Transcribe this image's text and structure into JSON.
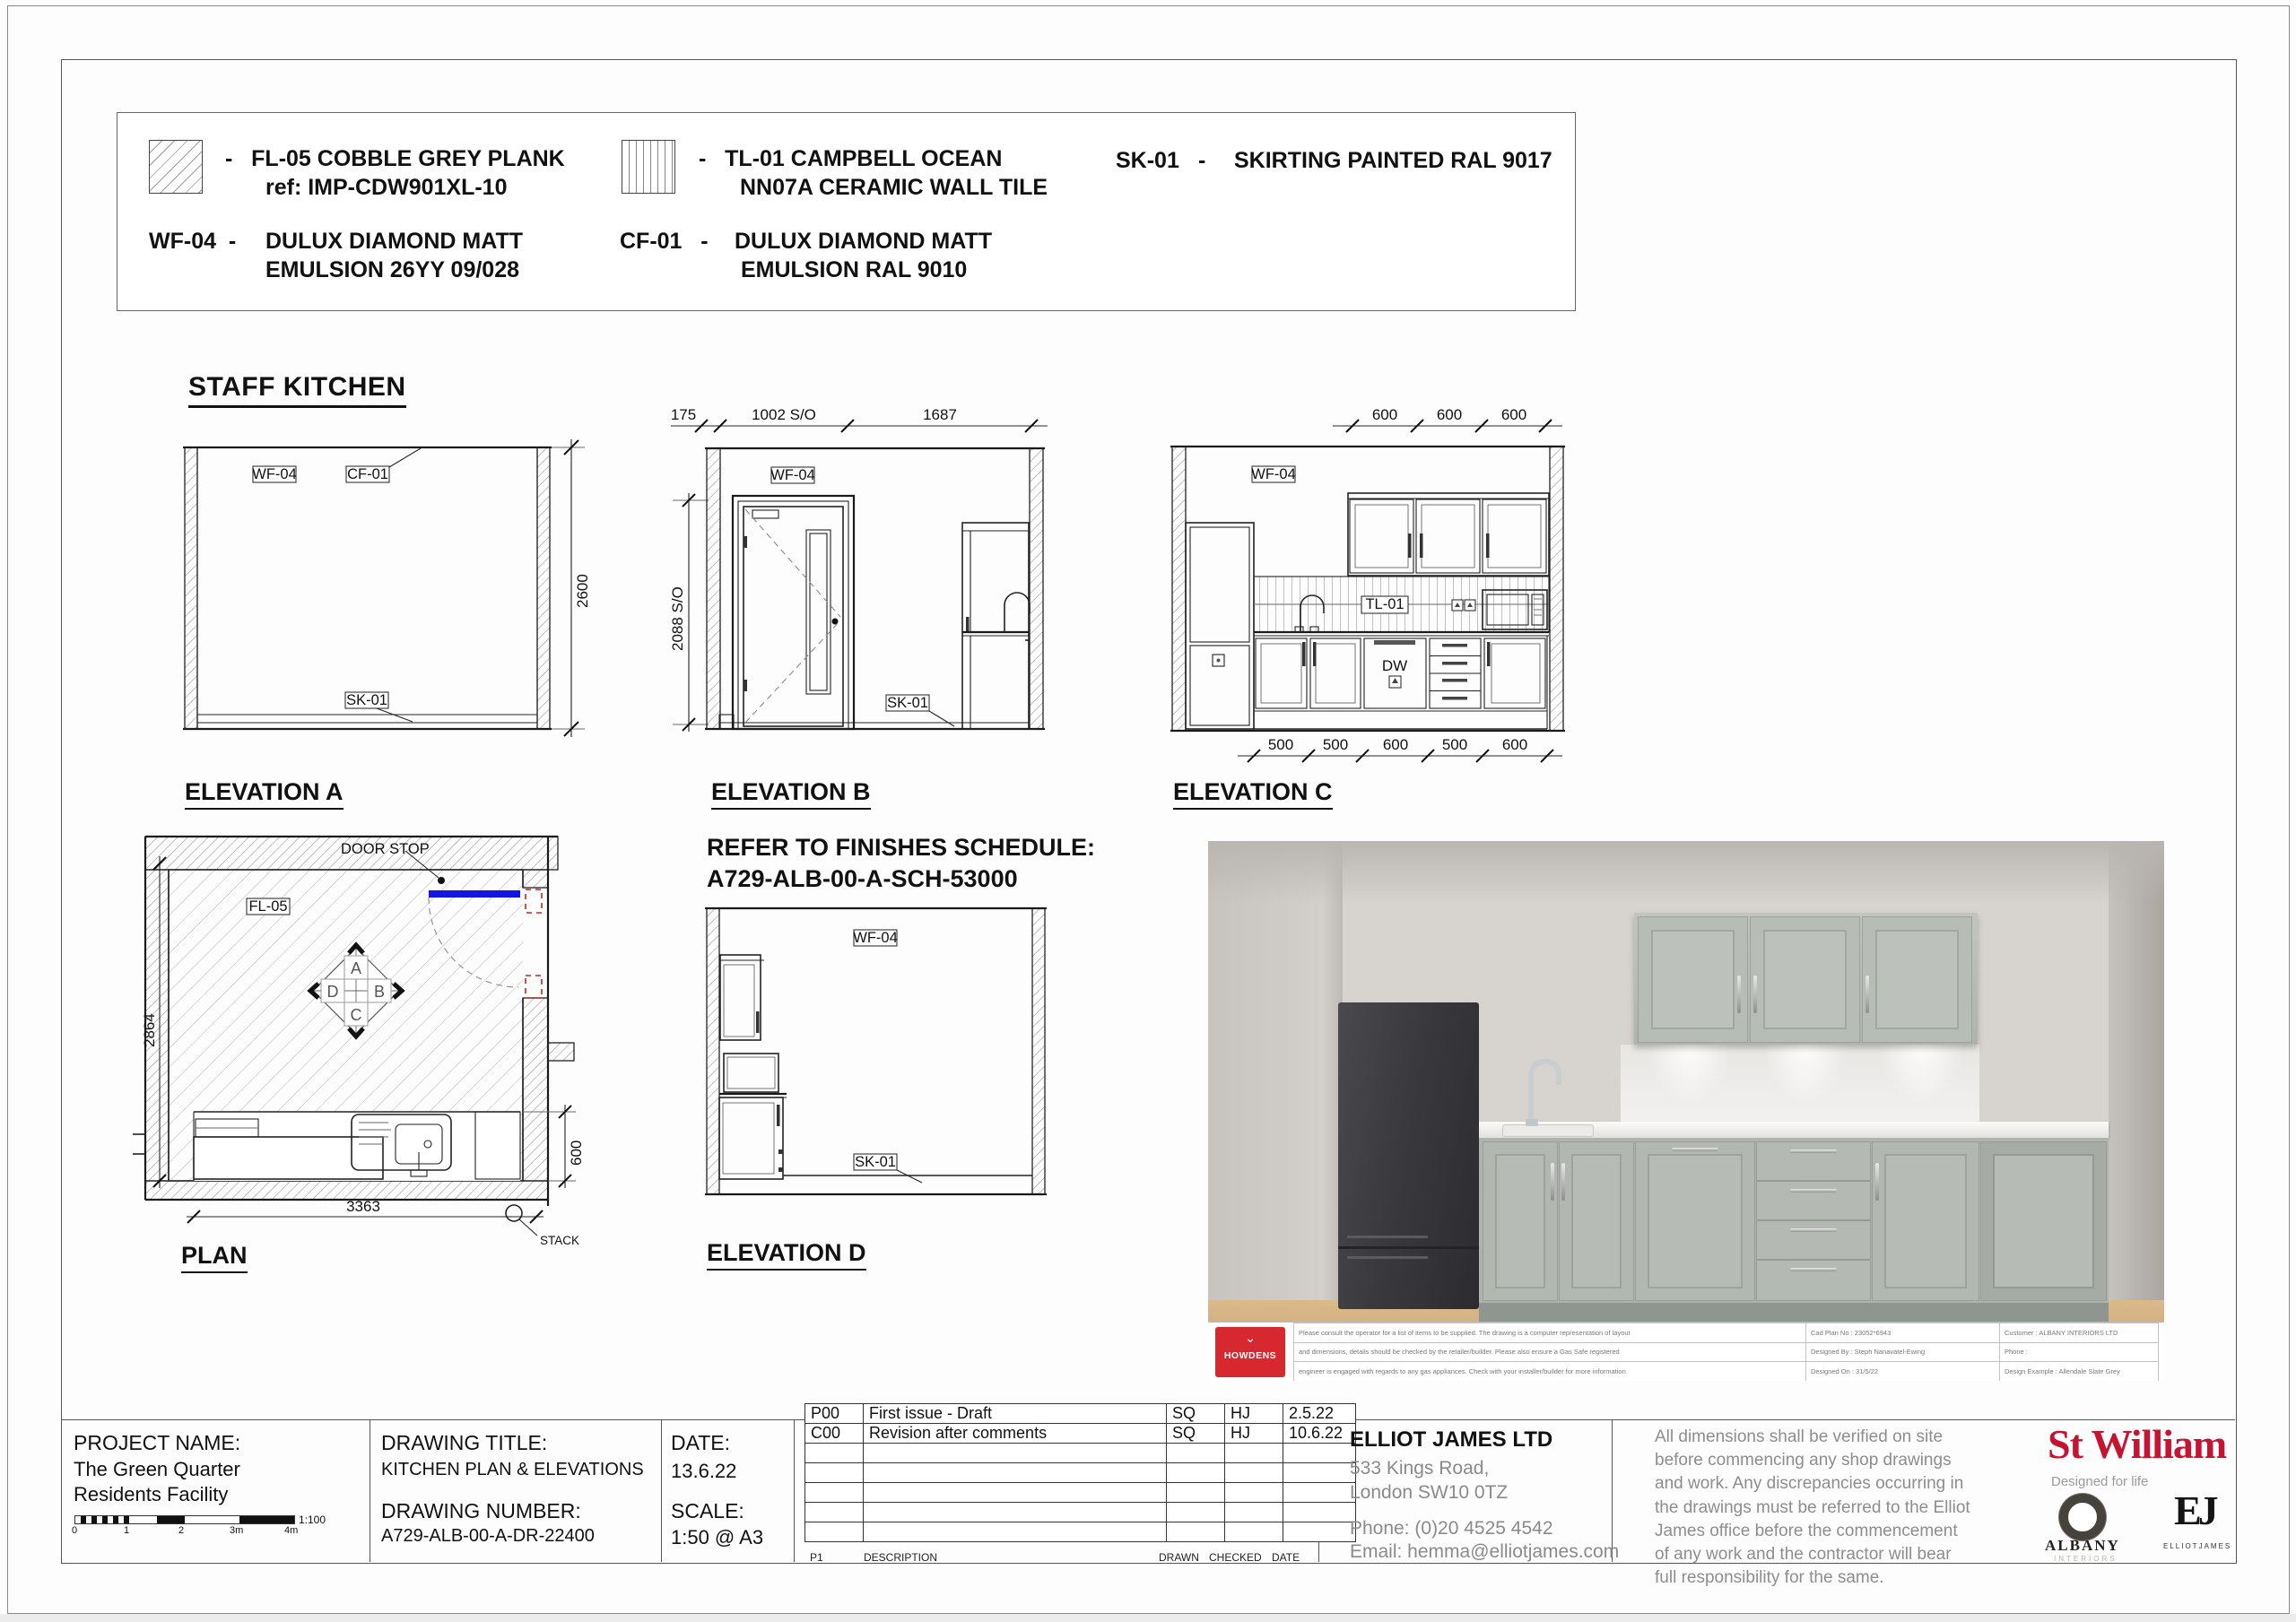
{
  "legend": {
    "fl05": {
      "line1": "-   FL-05 COBBLE GREY PLANK",
      "line2": "ref: IMP-CDW901XL-10"
    },
    "tl01": {
      "line1": "-   TL-01 CAMPBELL OCEAN",
      "line2": "NN07A CERAMIC WALL TILE"
    },
    "sk01": {
      "code": "SK-01",
      "dash": "-",
      "text": "SKIRTING PAINTED RAL 9017"
    },
    "wf04": {
      "code": "WF-04  -",
      "line1": "DULUX DIAMOND MATT",
      "line2": "EMULSION 26YY 09/028"
    },
    "cf01": {
      "code": "CF-01   -",
      "line1": "DULUX DIAMOND MATT",
      "line2": " EMULSION RAL 9010"
    }
  },
  "staff_kitchen_title": "STAFF KITCHEN",
  "finishes_note": {
    "line1": "REFER TO FINISHES SCHEDULE:",
    "line2": "A729-ALB-00-A-SCH-53000"
  },
  "elevA": {
    "title": "ELEVATION A",
    "wf04": "WF-04",
    "cf01": "CF-01",
    "sk01": "SK-01",
    "dim_height": "2600"
  },
  "elevB": {
    "title": "ELEVATION B",
    "d175": "175",
    "d1002": "1002 S/O",
    "d1687": "1687",
    "dheight": "2088 S/O",
    "wf04": "WF-04",
    "sk01": "SK-01"
  },
  "elevC": {
    "title": "ELEVATION C",
    "top_dims": [
      "600",
      "600",
      "600"
    ],
    "bottom_dims": [
      "500",
      "500",
      "600",
      "500",
      "600"
    ],
    "wf04": "WF-04",
    "tl01": "TL-01",
    "dw": "DW"
  },
  "elevD": {
    "title": "ELEVATION D",
    "wf04": "WF-04",
    "sk01": "SK-01"
  },
  "plan": {
    "title": "PLAN",
    "door_stop": "DOOR STOP",
    "fl05": "FL-05",
    "stack": "STACK",
    "dim_width": "3363",
    "dim_depth": "2864",
    "dim_counter": "600",
    "marker": [
      "A",
      "B",
      "C",
      "D"
    ]
  },
  "render_strip": {
    "howdens": "HOWDENS",
    "row1_desc": "Please consult the operator for a list of items to be supplied. The drawing is a computer representation of layout",
    "row1_mid": "Cad Plan No : 23052*6943",
    "row1_right": "Customer : ALBANY INTERIORS LTD",
    "row2_desc": "and dimensions, details should be checked by the retailer/builder. Please also ensure a Gas Safe registered",
    "row2_mid": "Designed By : Steph Nanavatel-Ewing",
    "row2_right": "Phone :",
    "row3_desc": "engineer is engaged with regards to any gas appliances. Check with your installer/builder for more information",
    "row3_mid": "Designed On : 31/5/22",
    "row3_right": "Design Example : Allendale Slate Grey"
  },
  "titleblock": {
    "project_label": "PROJECT NAME:",
    "project_line1": "The Green Quarter",
    "project_line2": "Residents Facility",
    "title_label": "DRAWING TITLE:",
    "title_value": "KITCHEN PLAN & ELEVATIONS",
    "number_label": "DRAWING NUMBER:",
    "number_value": "A729-ALB-00-A-DR-22400",
    "date_label": "DATE:",
    "date_value": "13.6.22",
    "scale_label": "SCALE:",
    "scale_value": "1:50 @ A3",
    "scalebar": {
      "t0": "0",
      "t1": "1",
      "t2": "2",
      "t3": "3m",
      "t4": "4m",
      "ratio": "1:100"
    },
    "revisions": [
      {
        "rev": "P00",
        "desc": "First issue - Draft",
        "drawn": "SQ",
        "checked": "HJ",
        "date": "2.5.22"
      },
      {
        "rev": "C00",
        "desc": "Revision after comments",
        "drawn": "SQ",
        "checked": "HJ",
        "date": "10.6.22"
      }
    ],
    "rev_footer": {
      "p1": "P1",
      "description": "DESCRIPTION",
      "drawn": "DRAWN",
      "checked": "CHECKED",
      "date": "DATE"
    },
    "company": {
      "name": "ELLIOT JAMES LTD",
      "addr1": "533 Kings Road,",
      "addr2": "London SW10 0TZ",
      "phone": "Phone: (0)20 4525 4542",
      "email": "Email: hemma@elliotjames.com"
    },
    "disclaimer": "All dimensions shall be verified on site before commencing any shop drawings and work. Any discrepancies occurring in the drawings must be referred to the Elliot James office before the commencement of any work and the contractor will bear full responsibility for the same."
  },
  "branding": {
    "stwilliam": "St William",
    "tagline": "Designed for life",
    "albany": "ALBANY",
    "albany_sub": "INTERIORS",
    "ej": "EJ",
    "ej_sub": "ELLIOTJAMES"
  }
}
